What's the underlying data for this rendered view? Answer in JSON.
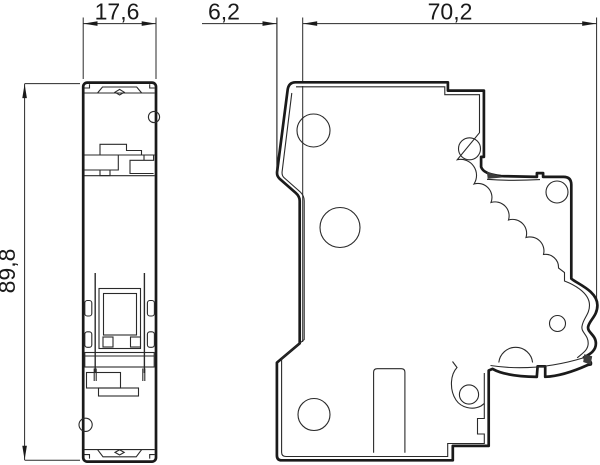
{
  "drawing": {
    "dimensions": {
      "front_width": "17,6",
      "front_offset": "6,2",
      "depth": "70,2",
      "height": "89,8"
    },
    "colors": {
      "line": "#1a1a1a",
      "background": "#ffffff"
    }
  }
}
